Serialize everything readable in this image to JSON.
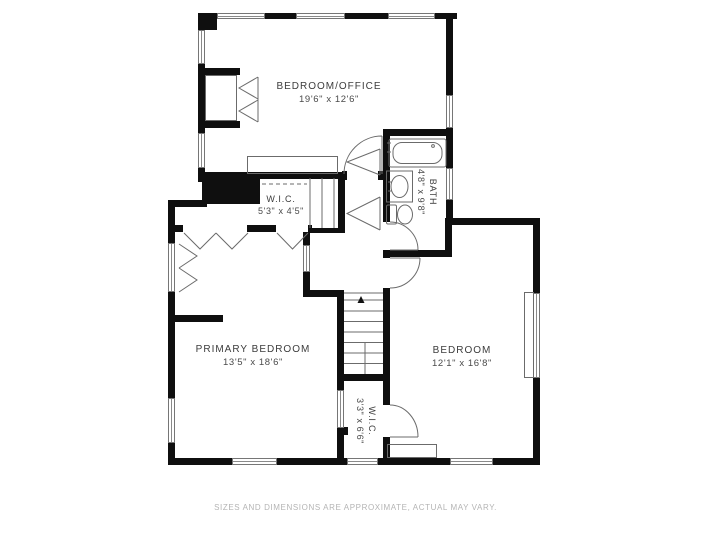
{
  "title": "Floor plan",
  "rooms": {
    "bedroom_office": {
      "name": "BEDROOM/OFFICE",
      "dims": "19'6\" x 12'6\""
    },
    "wic_upper": {
      "name": "W.I.C.",
      "dims": "5'3\" x 4'5\""
    },
    "bath": {
      "name": "BATH",
      "dims": "4'8\" x 9'8\""
    },
    "primary_bedroom": {
      "name": "PRIMARY BEDROOM",
      "dims": "13'5\" x 18'6\""
    },
    "bedroom": {
      "name": "BEDROOM",
      "dims": "12'1\" x 16'8\""
    },
    "wic_lower": {
      "name": "W.I.C.",
      "dims": "3'3\" x 6'6\""
    }
  },
  "footer": {
    "disclaimer": "SIZES AND DIMENSIONS ARE APPROXIMATE, ACTUAL MAY VARY."
  },
  "colors": {
    "wall": "#0f0f0f",
    "line": "#6b6b6b",
    "label": "#3c3c3c",
    "footer_text": "#b4b4b4",
    "background": "#ffffff"
  }
}
